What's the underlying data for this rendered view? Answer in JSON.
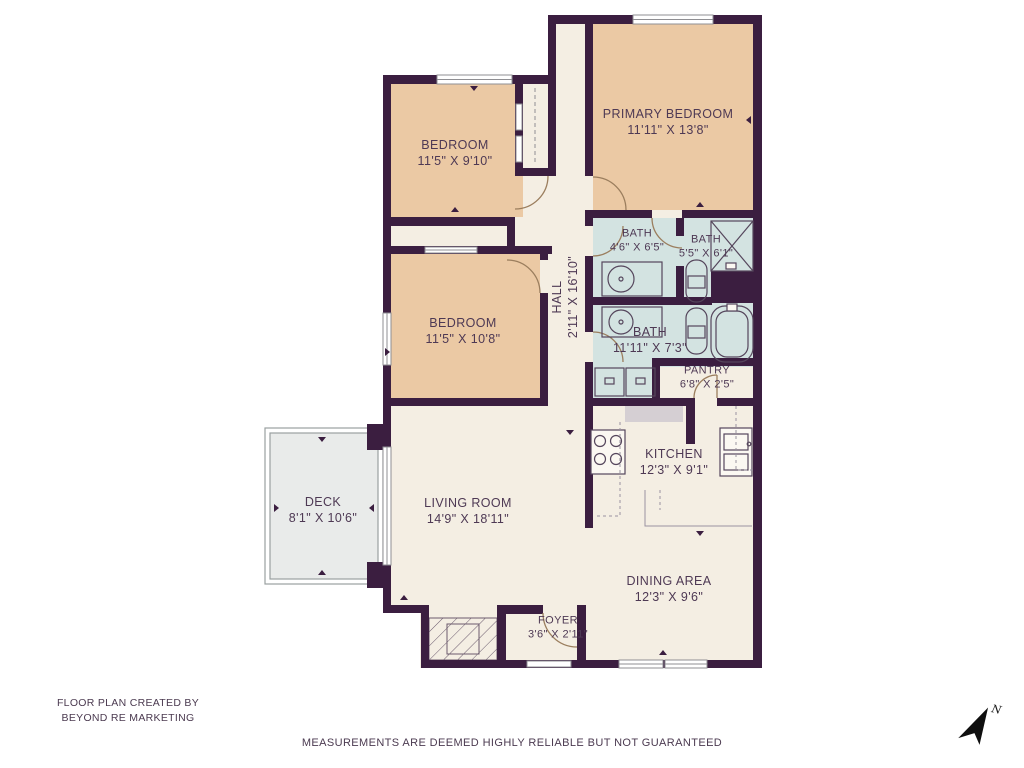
{
  "meta": {
    "credit_line1": "FLOOR PLAN CREATED BY",
    "credit_line2": "BEYOND RE MARKETING",
    "disclaimer": "MEASUREMENTS ARE DEEMED HIGHLY RELIABLE BUT NOT GUARANTEED",
    "compass_label": "N"
  },
  "rooms": {
    "primary_bedroom": {
      "name": "PRIMARY BEDROOM",
      "dims": "11'11\" X 13'8\""
    },
    "bedroom_top": {
      "name": "BEDROOM",
      "dims": "11'5\" X 9'10\""
    },
    "bedroom_mid": {
      "name": "BEDROOM",
      "dims": "11'5\" X 10'8\""
    },
    "hall": {
      "name": "HALL",
      "dims": "2'11\" X 16'10\""
    },
    "bath_1": {
      "name": "BATH",
      "dims": "4'6\" X 6'5\""
    },
    "bath_2": {
      "name": "BATH",
      "dims": "5'5\" X 6'1\""
    },
    "bath_3": {
      "name": "BATH",
      "dims": "11'11\" X 7'3\""
    },
    "pantry": {
      "name": "PANTRY",
      "dims": "6'8\" X 2'5\""
    },
    "kitchen": {
      "name": "KITCHEN",
      "dims": "12'3\" X 9'1\""
    },
    "living_room": {
      "name": "LIVING ROOM",
      "dims": "14'9\" X 18'11\""
    },
    "dining_area": {
      "name": "DINING AREA",
      "dims": "12'3\" X 9'6\""
    },
    "deck": {
      "name": "DECK",
      "dims": "8'1\" X 10'6\""
    },
    "foyer": {
      "name": "FOYER",
      "dims": "3'6\" X 2'11\""
    }
  },
  "colors": {
    "wall": "#3b1e40",
    "floor": "#f4eee3",
    "bedroom": "#ebc9a4",
    "bath": "#d3e3e1",
    "deck": "#e9ebea",
    "text": "#4e3954"
  }
}
